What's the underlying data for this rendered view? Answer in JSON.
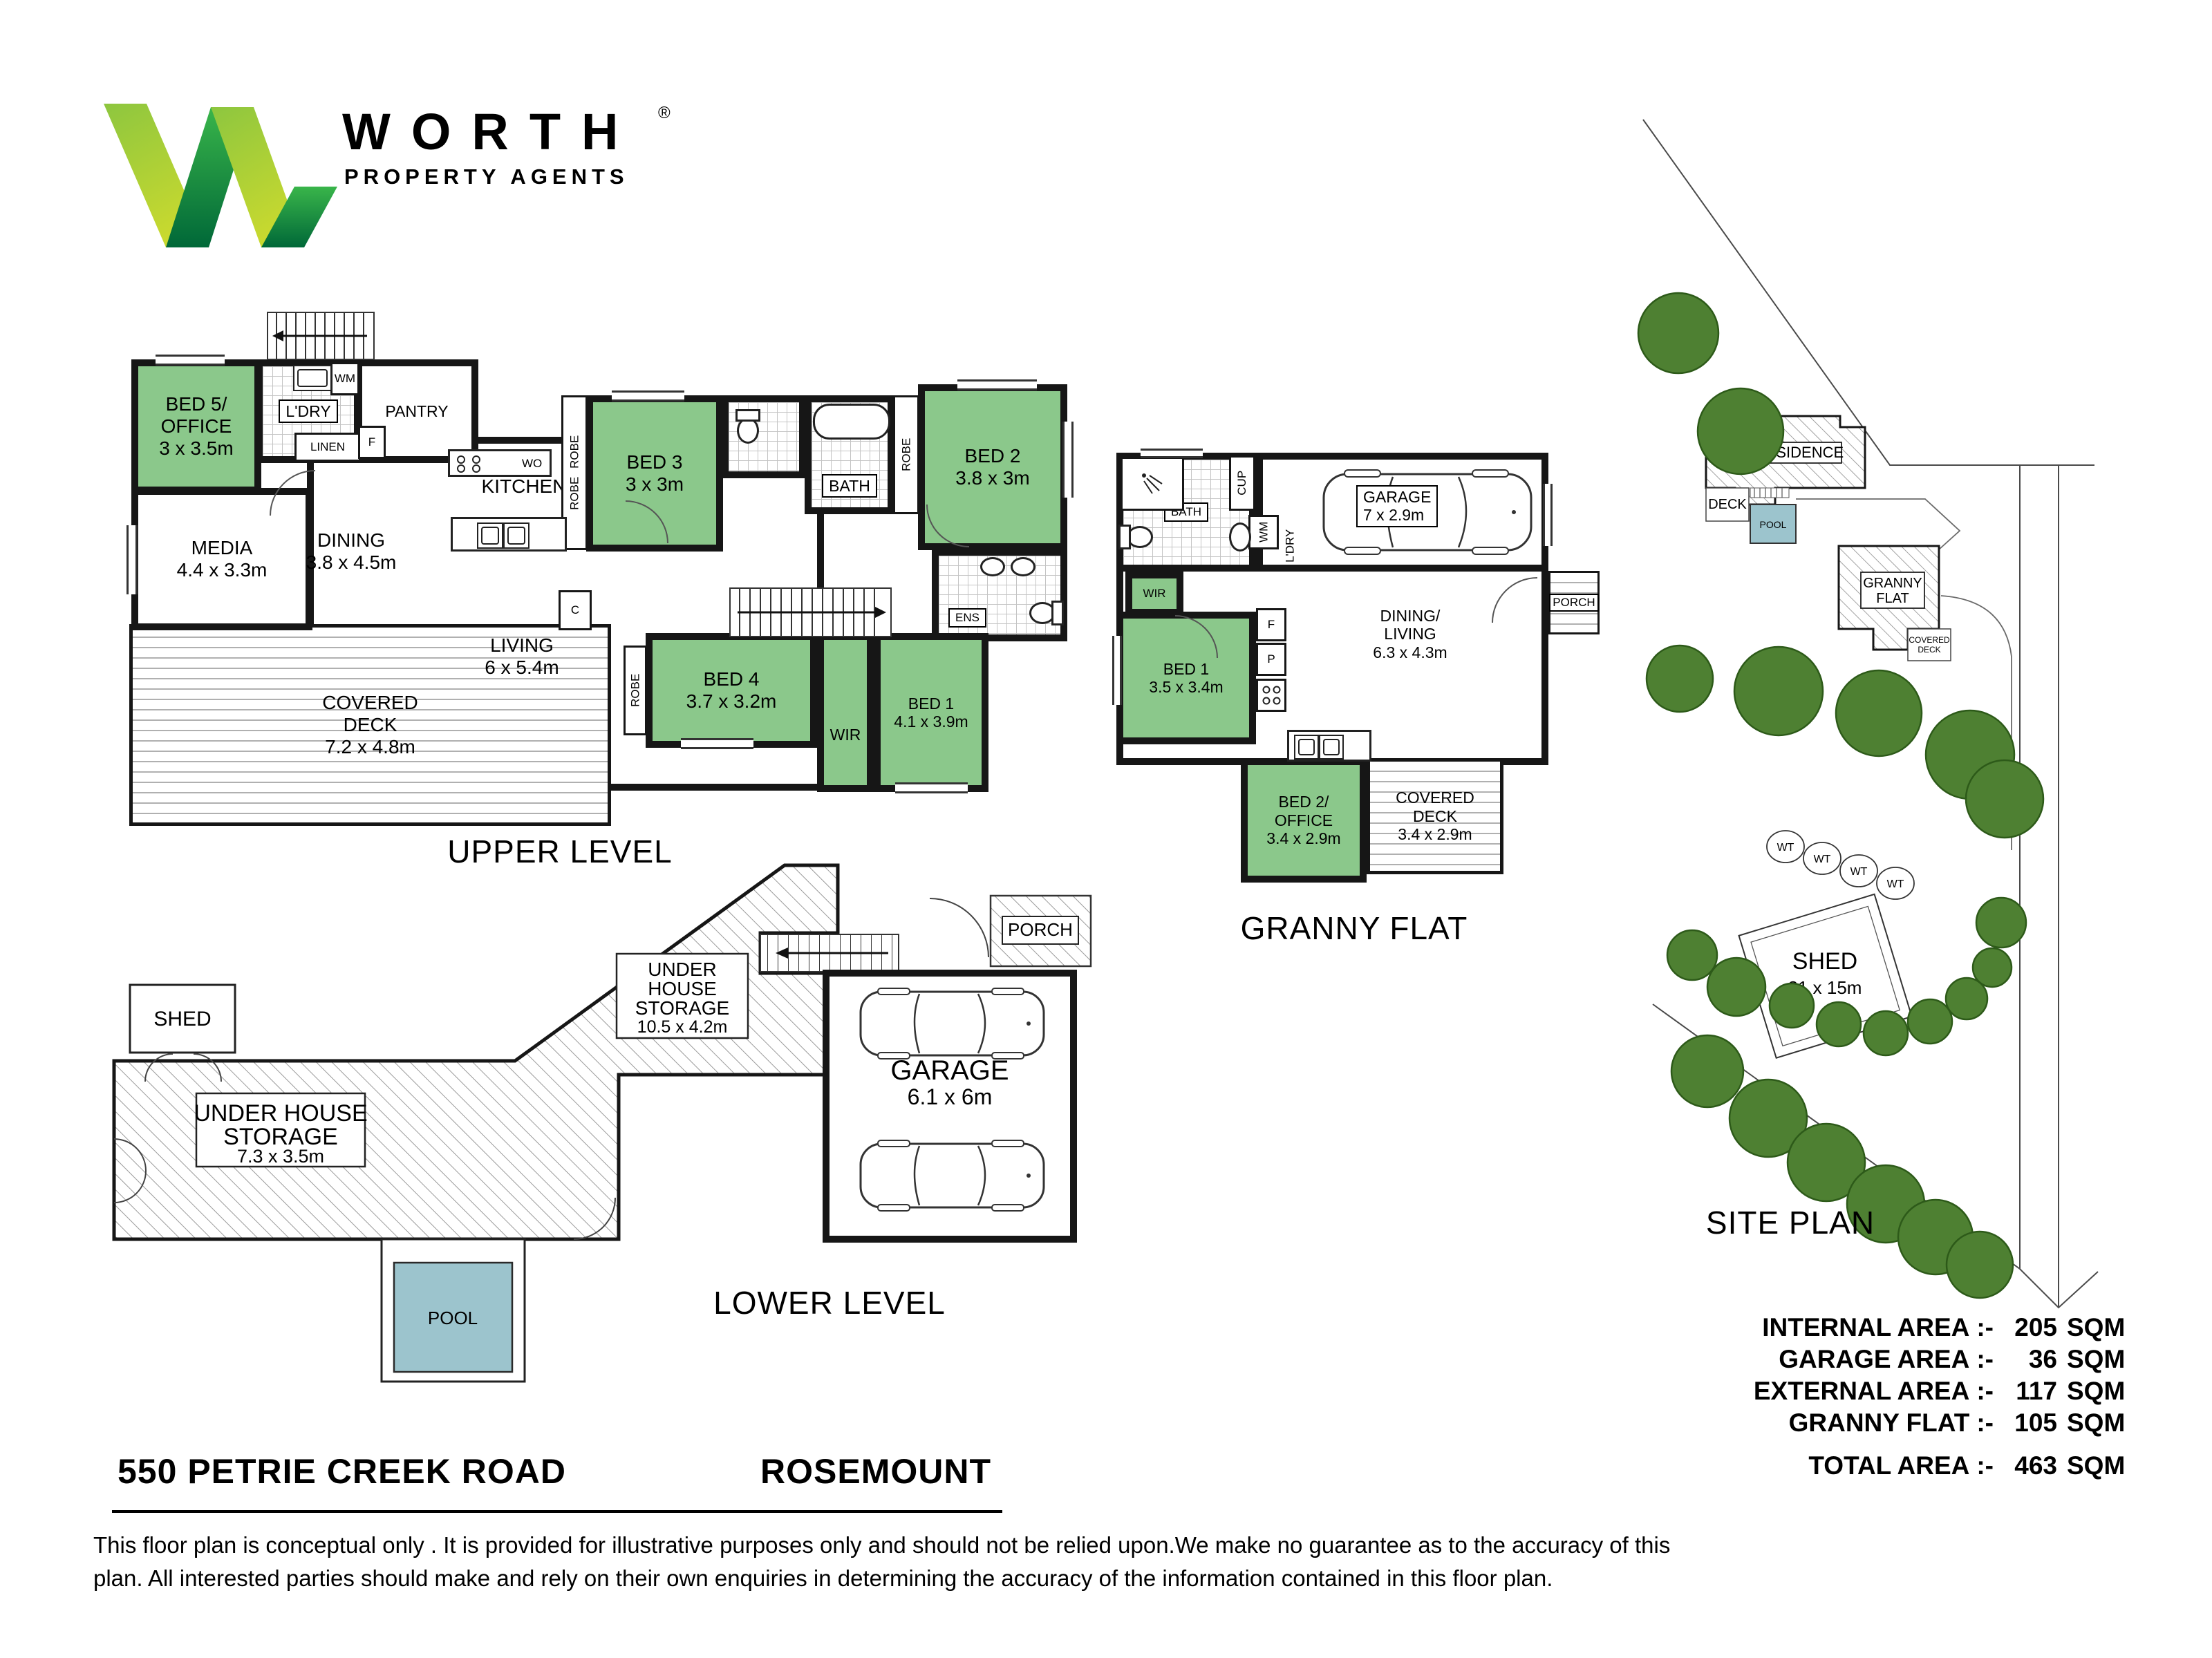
{
  "logo": {
    "brand": "WORTH",
    "registered": "®",
    "tagline": "PROPERTY AGENTS"
  },
  "upper": {
    "caption": "UPPER LEVEL",
    "bed5": "BED 5/\nOFFICE\n3 x 3.5m",
    "media": "MEDIA\n4.4 x 3.3m",
    "ldry": "L'DRY",
    "wm": "WM",
    "linen": "LINEN",
    "pantry": "PANTRY",
    "fridge": "F",
    "closet": "C",
    "kitchen": "KITCHEN",
    "wallOven": "WO",
    "dining": "DINING\n3.8 x 4.5m",
    "living": "LIVING\n6 x 5.4m",
    "coveredDeck": "COVERED\nDECK\n7.2 x 4.8m",
    "robe": "ROBE",
    "bed3": "BED 3\n3 x 3m",
    "bath": "BATH",
    "ens": "ENS",
    "bed2": "BED 2\n3.8 x 3m",
    "bed4": "BED 4\n3.7 x 3.2m",
    "wir": "WIR",
    "bed1": "BED 1\n4.1 x 3.9m"
  },
  "granny": {
    "caption": "GRANNY FLAT",
    "bath": "BATH",
    "cup": "CUP",
    "wm": "WM",
    "ldry": "L'DRY",
    "garage": "GARAGE\n7 x 2.9m",
    "porch": "PORCH",
    "wir": "WIR",
    "bed1": "BED 1\n3.5 x 3.4m",
    "fridge": "F",
    "pantry": "P",
    "dining": "DINING/\nLIVING\n6.3 x 4.3m",
    "bed2": "BED 2/\nOFFICE\n3.4 x 2.9m",
    "coveredDeck": "COVERED\nDECK\n3.4 x 2.9m"
  },
  "lower": {
    "caption": "LOWER LEVEL",
    "shed": "SHED",
    "storageLeft": [
      "UNDER HOUSE",
      "STORAGE",
      "7.3 x 3.5m"
    ],
    "storageRight": [
      "UNDER",
      "HOUSE",
      "STORAGE",
      "10.5 x 4.2m"
    ],
    "garage": [
      "GARAGE",
      "6.1 x 6m"
    ],
    "porch": "PORCH",
    "pool": "POOL"
  },
  "site": {
    "caption": "SITE PLAN",
    "residence": "RESIDENCE",
    "deck": "DECK",
    "pool": "POOL",
    "granny": [
      "GRANNY",
      "FLAT"
    ],
    "coveredDeck": [
      "COVERED",
      "DECK"
    ],
    "shed": [
      "SHED",
      "21 x 15m"
    ],
    "wt": "WT"
  },
  "address": {
    "street": "550 PETRIE CREEK ROAD",
    "suburb": "ROSEMOUNT"
  },
  "areas": {
    "separator": ":-",
    "rows": [
      {
        "label": "INTERNAL AREA",
        "value": "205",
        "unit": "SQM"
      },
      {
        "label": "GARAGE AREA",
        "value": "36",
        "unit": "SQM"
      },
      {
        "label": "EXTERNAL AREA",
        "value": "117",
        "unit": "SQM"
      },
      {
        "label": "GRANNY FLAT",
        "value": "105",
        "unit": "SQM"
      },
      {
        "label": "TOTAL AREA",
        "value": "463",
        "unit": "SQM"
      }
    ]
  },
  "disclaimer": "This floor plan  is conceptual only . It is provided for illustrative purposes only and should not be relied upon.We make no guarantee as to the accuracy of this\nplan. All interested parties should make and rely on their own enquiries in determining the accuracy of the information contained in this floor plan.",
  "colors": {
    "roomGreen": "#8bc88b",
    "poolBlue": "#9cc4cd",
    "treeGreen": "#4e8032",
    "logoLight": "#8dc63f",
    "logoDark": "#00703c"
  }
}
